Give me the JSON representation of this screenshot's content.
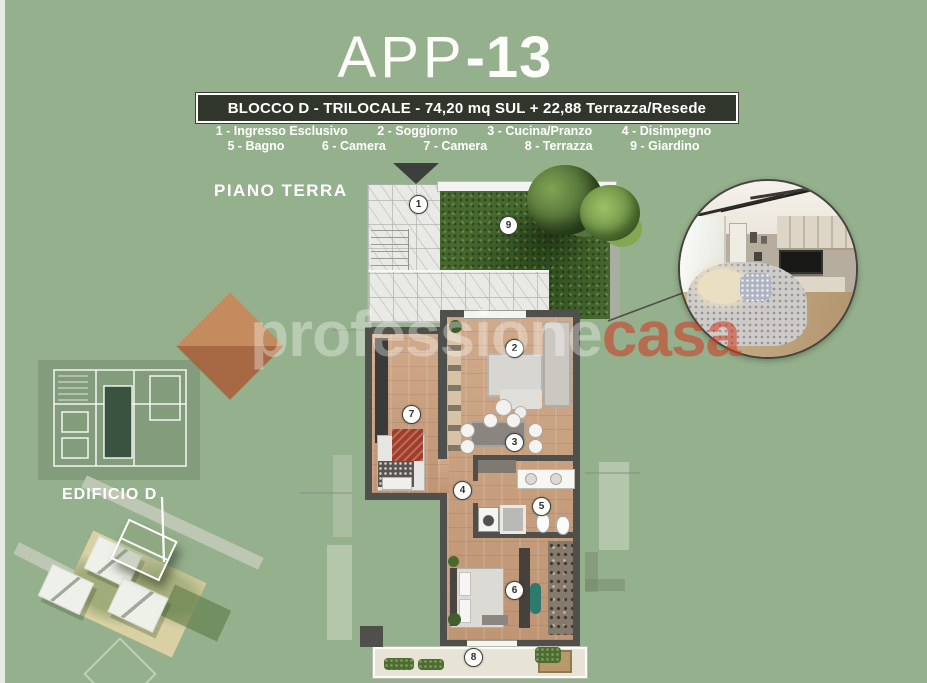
{
  "colors": {
    "background": "#95b08c",
    "banner_bg": "#31362c",
    "wall": "#4f4f4b",
    "wood_floor": "#c79e7c",
    "marble": "#e9e9e6",
    "garden_green": "#47682f",
    "watermark_red": "#d2371e",
    "watermark_diamond": "#c68a5c",
    "text": "#ffffff"
  },
  "header": {
    "title_thin": "APP",
    "title_bold": "-13",
    "banner": "BLOCCO D - TRILOCALE - 74,20 mq SUL + 22,88 Terrazza/Resede"
  },
  "legend": {
    "row1": [
      "1 - Ingresso Esclusivo",
      "2 - Soggiorno",
      "3 - Cucina/Pranzo",
      "4 - Disimpegno"
    ],
    "row2": [
      "5 - Bagno",
      "6 - Camera",
      "7 - Camera",
      "8 - Terrazza",
      "9 - Giardino"
    ]
  },
  "plan": {
    "floor_label": "PIANO TERRA",
    "markers": [
      "1",
      "2",
      "3",
      "4",
      "5",
      "6",
      "7",
      "8",
      "9"
    ]
  },
  "site": {
    "building_label": "EDIFICIO D"
  },
  "watermark": {
    "white": "professione",
    "red": "casa"
  }
}
